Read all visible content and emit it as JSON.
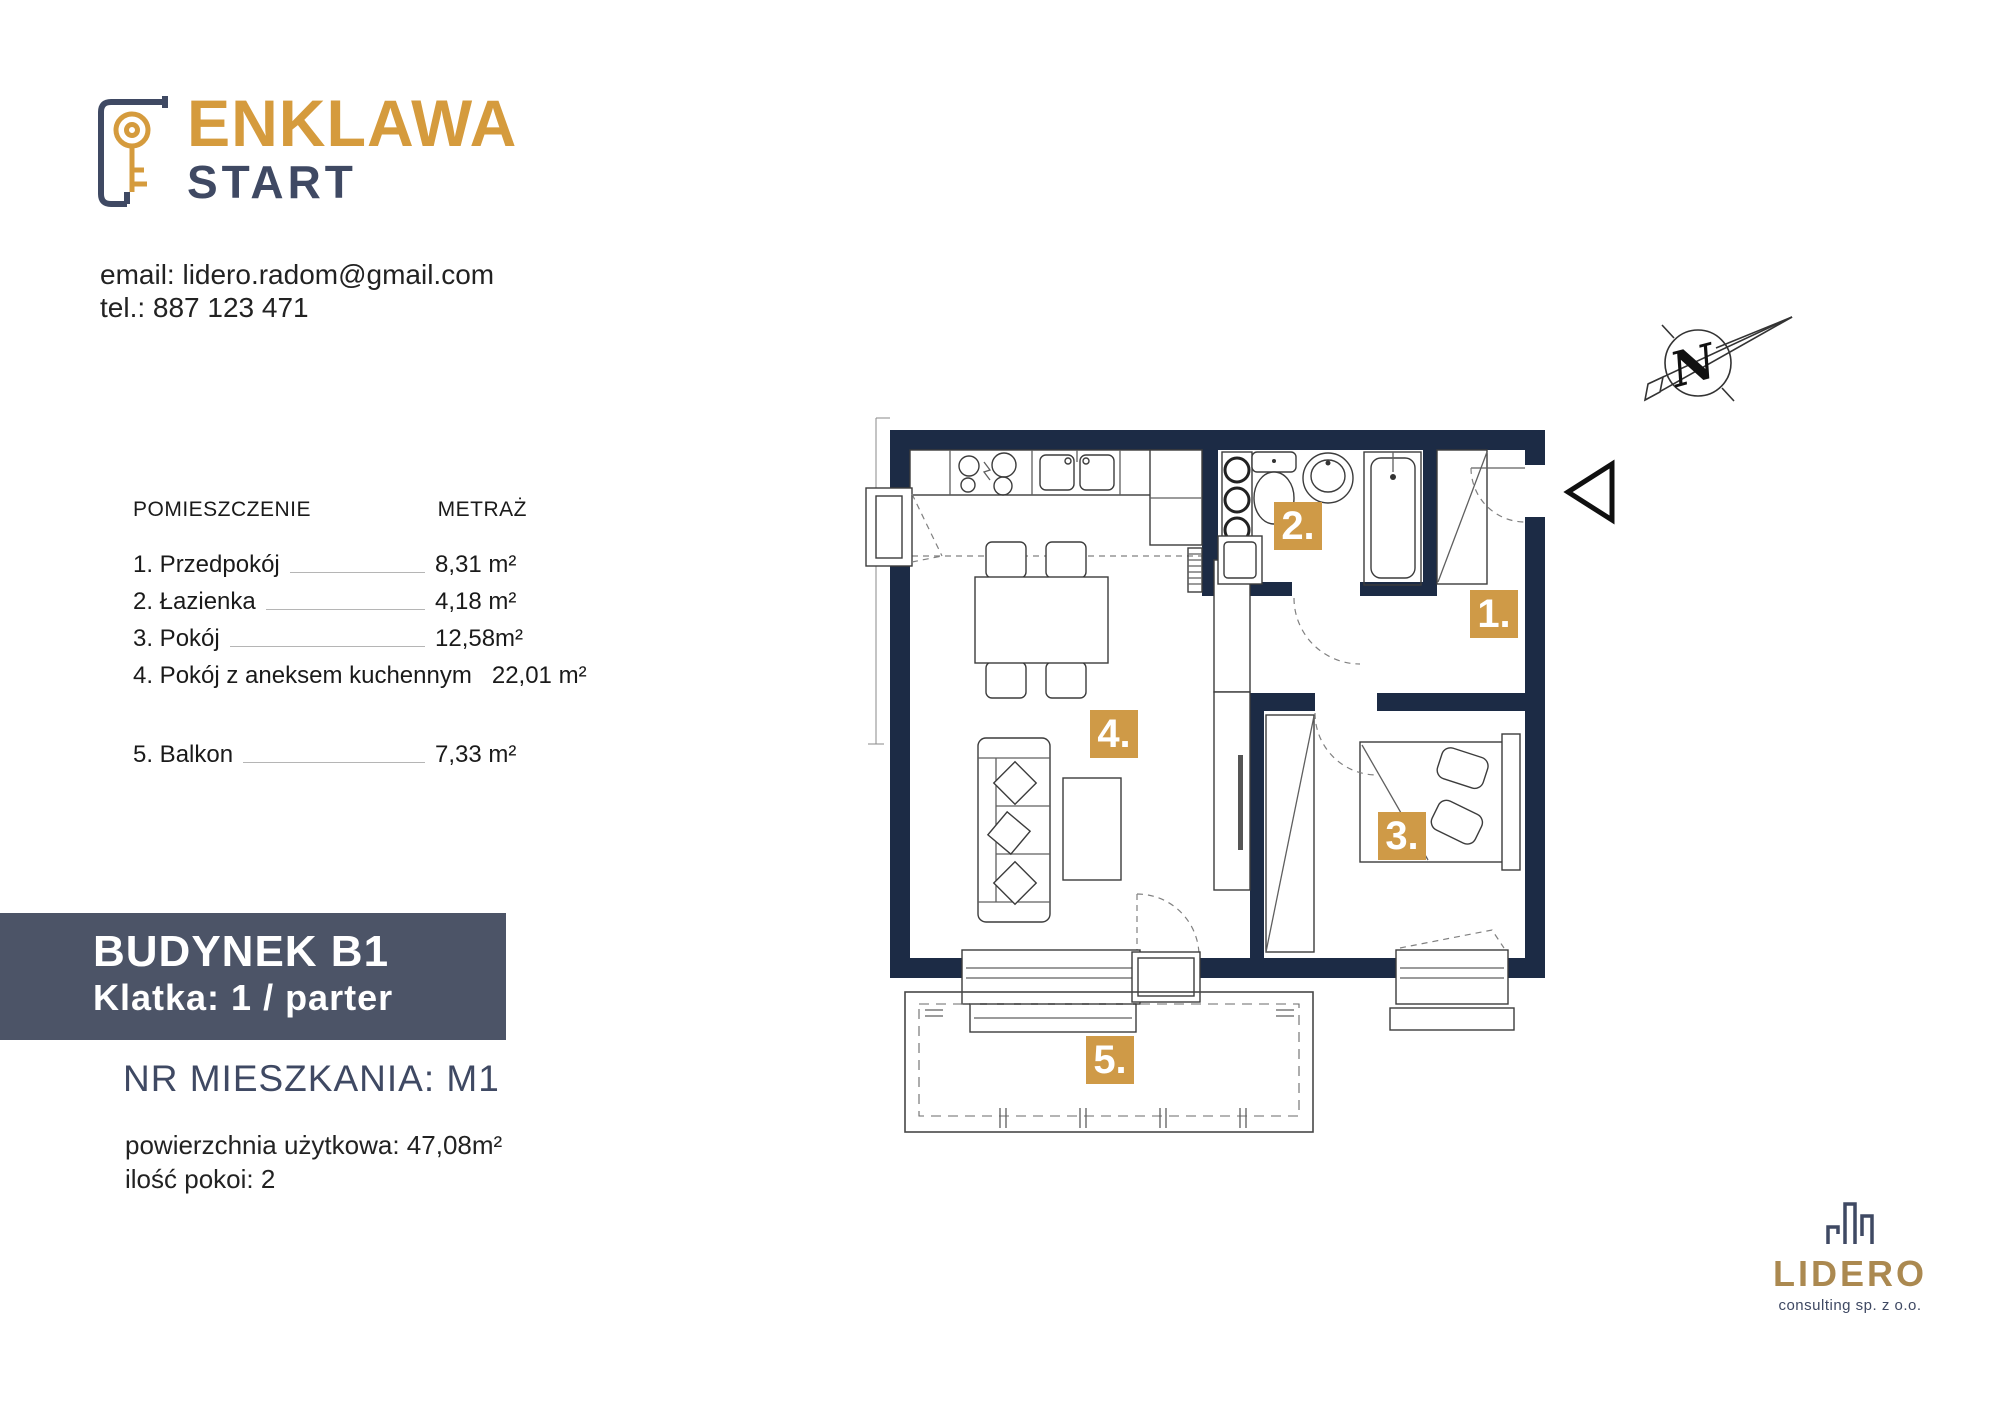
{
  "brand": {
    "name_top": "ENKLAWA",
    "name_bottom": "START"
  },
  "contact": {
    "email_line": "email: lidero.radom@gmail.com",
    "phone_line": "tel.: 887 123 471"
  },
  "room_table": {
    "header_room": "POMIESZCZENIE",
    "header_area": "METRAŻ",
    "rows": [
      {
        "label": "1. Przedpokój",
        "value": "8,31 m²"
      },
      {
        "label": "2. Łazienka",
        "value": "4,18 m²"
      },
      {
        "label": "3. Pokój",
        "value": "12,58m²"
      },
      {
        "label": "4. Pokój z aneksem kuchennym",
        "value": "22,01 m²"
      },
      {
        "label": "5. Balkon",
        "value": "7,33 m²"
      }
    ]
  },
  "building": {
    "line1": "BUDYNEK B1",
    "line2": "Klatka: 1 / parter"
  },
  "apartment": {
    "number_line": "NR MIESZKANIA: M1",
    "area_line": "powierzchnia użytkowa: 47,08m²",
    "rooms_line": "ilość pokoi: 2"
  },
  "plan": {
    "labels": {
      "hall": "1.",
      "bath": "2.",
      "bedroom": "3.",
      "living": "4.",
      "balcony": "5."
    },
    "compass_letter": "N"
  },
  "footer_logo": {
    "name": "LIDERO",
    "subtitle": "consulting sp. z o.o."
  },
  "colors": {
    "brand_gold": "#d59b3d",
    "badge_gold": "#cf9a47",
    "wall_navy": "#1c2b45",
    "banner_slate": "#4c5467",
    "navy_text": "#3f4963",
    "lidero_gold": "#ab8950"
  }
}
